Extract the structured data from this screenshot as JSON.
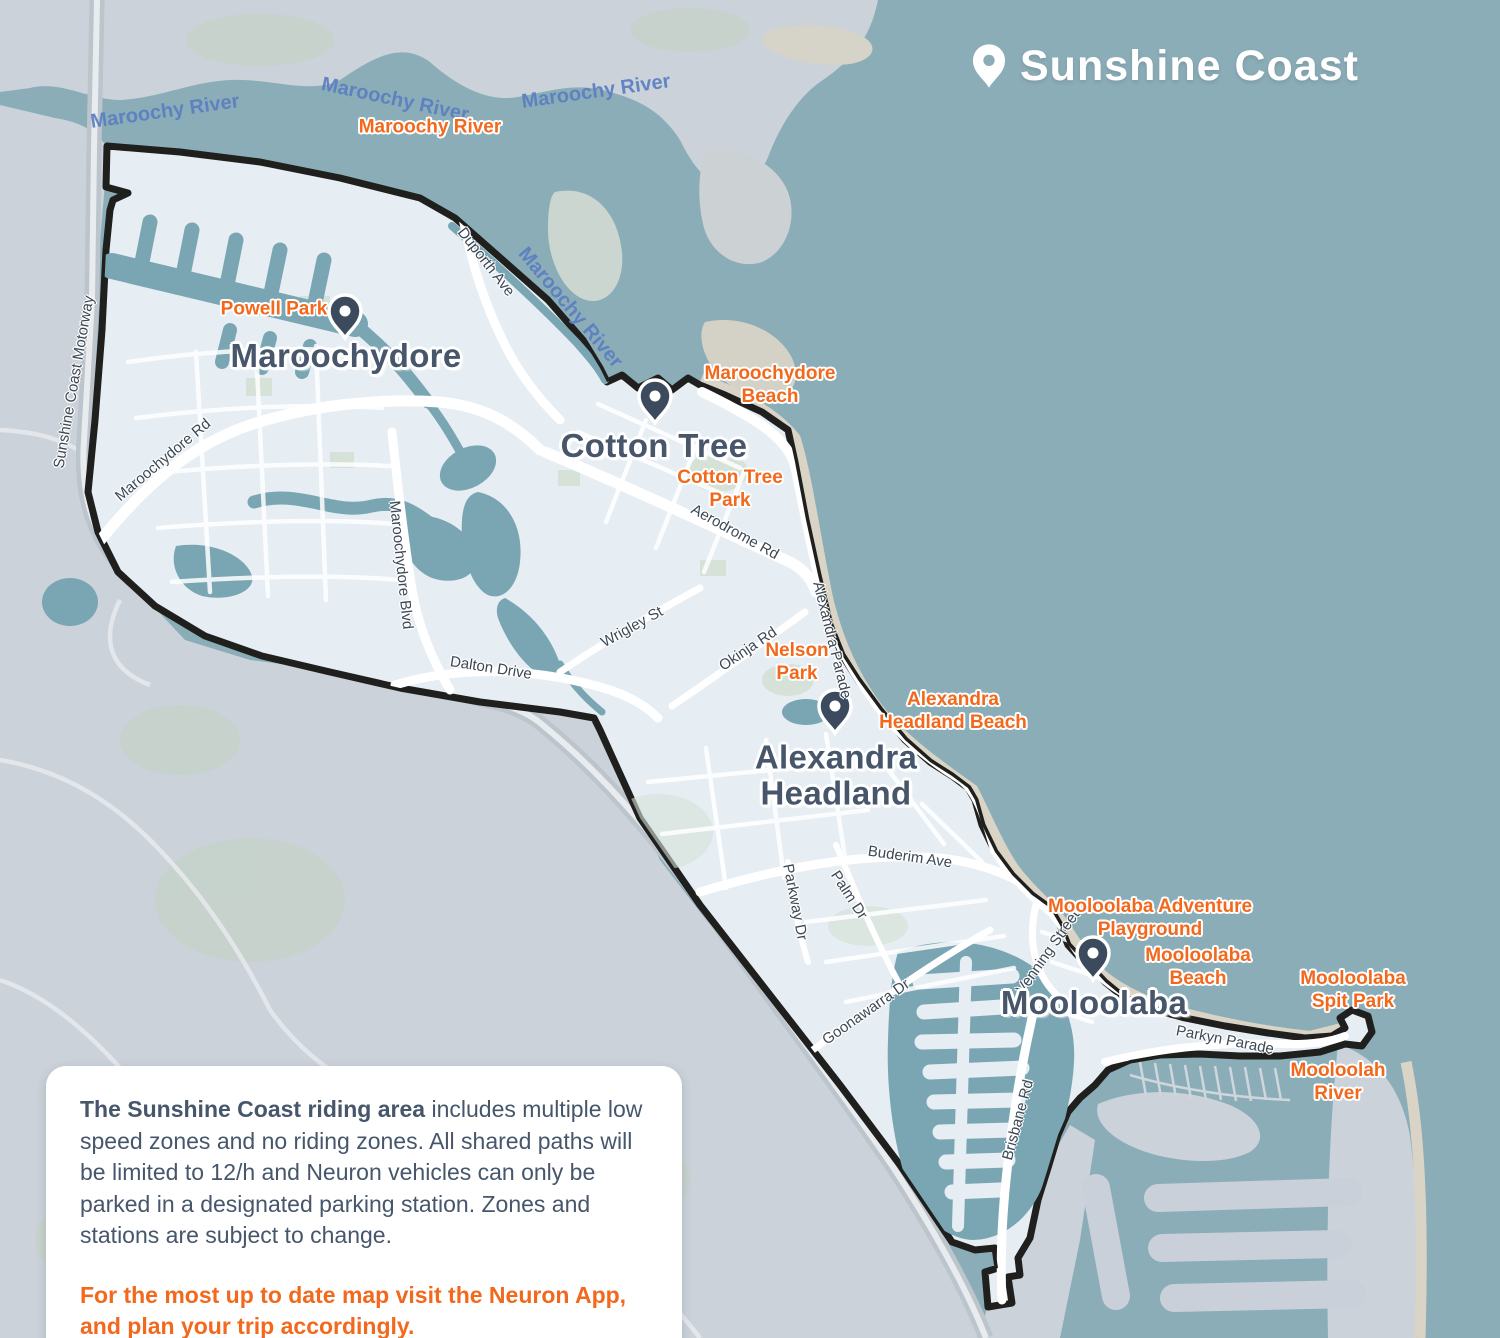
{
  "title": {
    "label": "Sunshine Coast"
  },
  "places": [
    {
      "name": "Maroochydore"
    },
    {
      "name": "Cotton Tree"
    },
    {
      "name": "Alexandra\nHeadland"
    },
    {
      "name": "Mooloolaba"
    }
  ],
  "pois": [
    {
      "name": "Maroochy River"
    },
    {
      "name": "Powell Park"
    },
    {
      "name": "Maroochydore\nBeach"
    },
    {
      "name": "Cotton Tree\nPark"
    },
    {
      "name": "Nelson\nPark"
    },
    {
      "name": "Alexandra\nHeadland Beach"
    },
    {
      "name": "Mooloolaba Adventure\nPlayground"
    },
    {
      "name": "Mooloolaba\nBeach"
    },
    {
      "name": "Mooloolaba\nSpit Park"
    },
    {
      "name": "Mooloolah\nRiver"
    }
  ],
  "waterways": [
    {
      "name": "Maroochy River"
    },
    {
      "name": "Maroochy River"
    },
    {
      "name": "Maroochy River"
    },
    {
      "name": "Maroochy River"
    }
  ],
  "roads": [
    {
      "name": "Sunshine Coast Motorway"
    },
    {
      "name": "Maroochydore Rd"
    },
    {
      "name": "Duporth Ave"
    },
    {
      "name": "Maroochydore Blvd"
    },
    {
      "name": "Dalton Drive"
    },
    {
      "name": "Wrigley St"
    },
    {
      "name": "Aerodrome Rd"
    },
    {
      "name": "Okinja Rd"
    },
    {
      "name": "Alexandra Parade"
    },
    {
      "name": "Buderim Ave"
    },
    {
      "name": "Parkway Dr"
    },
    {
      "name": "Palm Dr"
    },
    {
      "name": "Goonawarra Dr"
    },
    {
      "name": "Venning Street"
    },
    {
      "name": "Brisbane Rd"
    },
    {
      "name": "Parkyn Parade"
    }
  ],
  "info_box": {
    "lead_bold": "The Sunshine Coast riding area",
    "lead_rest": " includes multiple low speed zones and no riding zones. All shared paths will be limited to 12/h and Neuron vehicles can only be parked in a designated parking station. Zones and stations are subject to change.",
    "cta": "For the most up to date map visit the Neuron App, and plan your trip accordingly."
  },
  "colors": {
    "ocean": "#8badb8",
    "land_outside_zone": "#cbd2d9",
    "riding_zone_fill": "#e6edf3",
    "zone_boundary": "#1f1f1d",
    "canal_water": "#7aa6b4",
    "beach_sand": "#d9d4c6",
    "poi_orange": "#f2691d",
    "place_slate": "#47566b",
    "river_label_blue": "#5b7ec1"
  }
}
